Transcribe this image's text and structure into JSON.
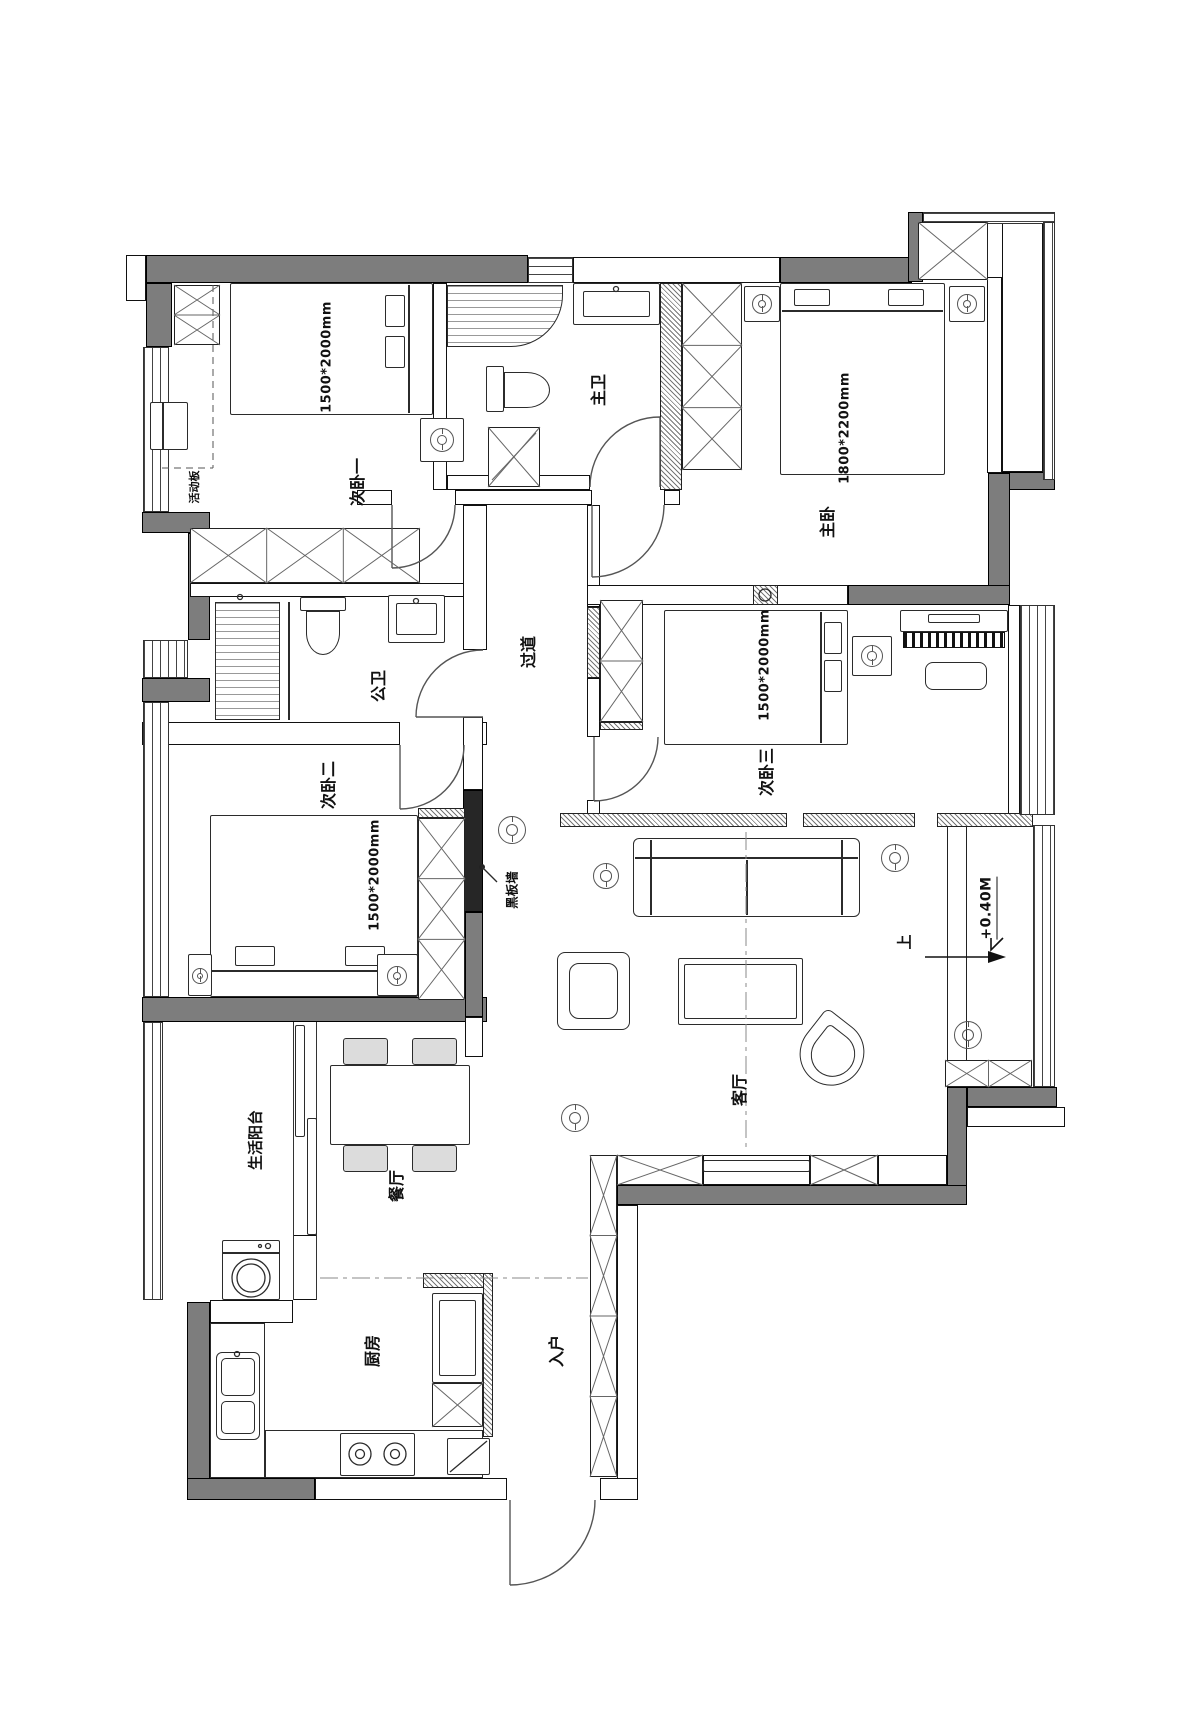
{
  "plan_type": "apartment-floor-plan",
  "rooms": {
    "bedroom1": {
      "label": "次卧一",
      "bed_dimension": "1500*2000mm"
    },
    "master_bathroom": {
      "label": "主卫"
    },
    "master_bedroom": {
      "label": "主卧",
      "bed_dimension": "1800*2200mm"
    },
    "hallway": {
      "label": "过道"
    },
    "public_bathroom": {
      "label": "公卫"
    },
    "bedroom2": {
      "label": "次卧二",
      "bed_dimension": "1500*2000mm"
    },
    "bedroom3": {
      "label": "次卧三",
      "bed_dimension": "1500*2000mm"
    },
    "living_room": {
      "label": "客厅"
    },
    "dining_room": {
      "label": "餐厅"
    },
    "service_balcony": {
      "label": "生活阳台"
    },
    "kitchen": {
      "label": "厨房"
    },
    "entry": {
      "label": "入户"
    }
  },
  "annotations": {
    "blackboard_wall": "黑板墙",
    "movable_panel": "活动板",
    "stair_up": "上",
    "floor_elevation": "+0.40M"
  },
  "colors": {
    "exterior_wall": "#7d7d7d",
    "blackboard_wall": "#262626",
    "linework": "#1a1a1a"
  }
}
